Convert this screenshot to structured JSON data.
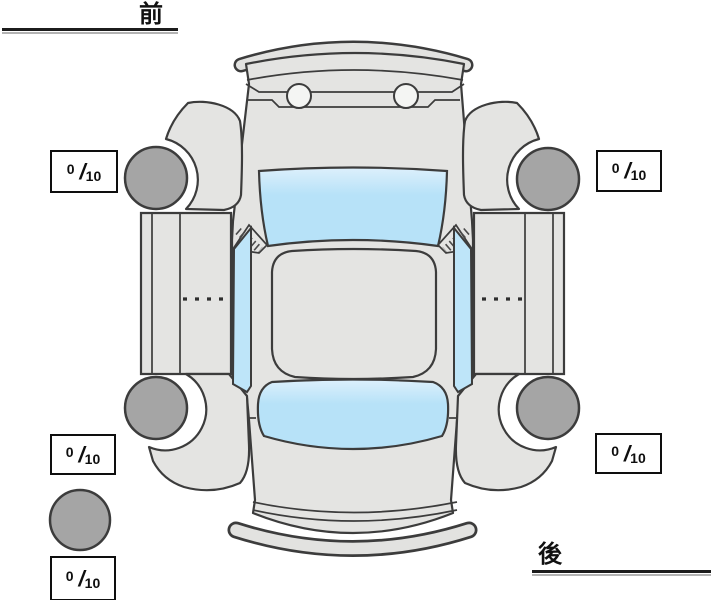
{
  "labels": {
    "front": "前",
    "rear": "後"
  },
  "scores": {
    "front_left": {
      "value": "0",
      "separator": "/",
      "max": "10"
    },
    "front_right": {
      "value": "0",
      "separator": "/",
      "max": "10"
    },
    "rear_left": {
      "value": "0",
      "separator": "/",
      "max": "10"
    },
    "rear_right": {
      "value": "0",
      "separator": "/",
      "max": "10"
    },
    "spare": {
      "value": "0",
      "separator": "/",
      "max": "10"
    }
  },
  "diagram": {
    "type": "car-top-view-tire-condition-diagram",
    "wheel_positions": [
      "front-left",
      "front-right",
      "rear-left",
      "rear-right",
      "spare"
    ],
    "colors": {
      "background": "#ffffff",
      "body": "#e4e4e2",
      "glass": "#b7e2f8",
      "wheel": "#a5a5a5",
      "outline": "#3c3c3c",
      "score_border": "#0e0e0e"
    }
  }
}
